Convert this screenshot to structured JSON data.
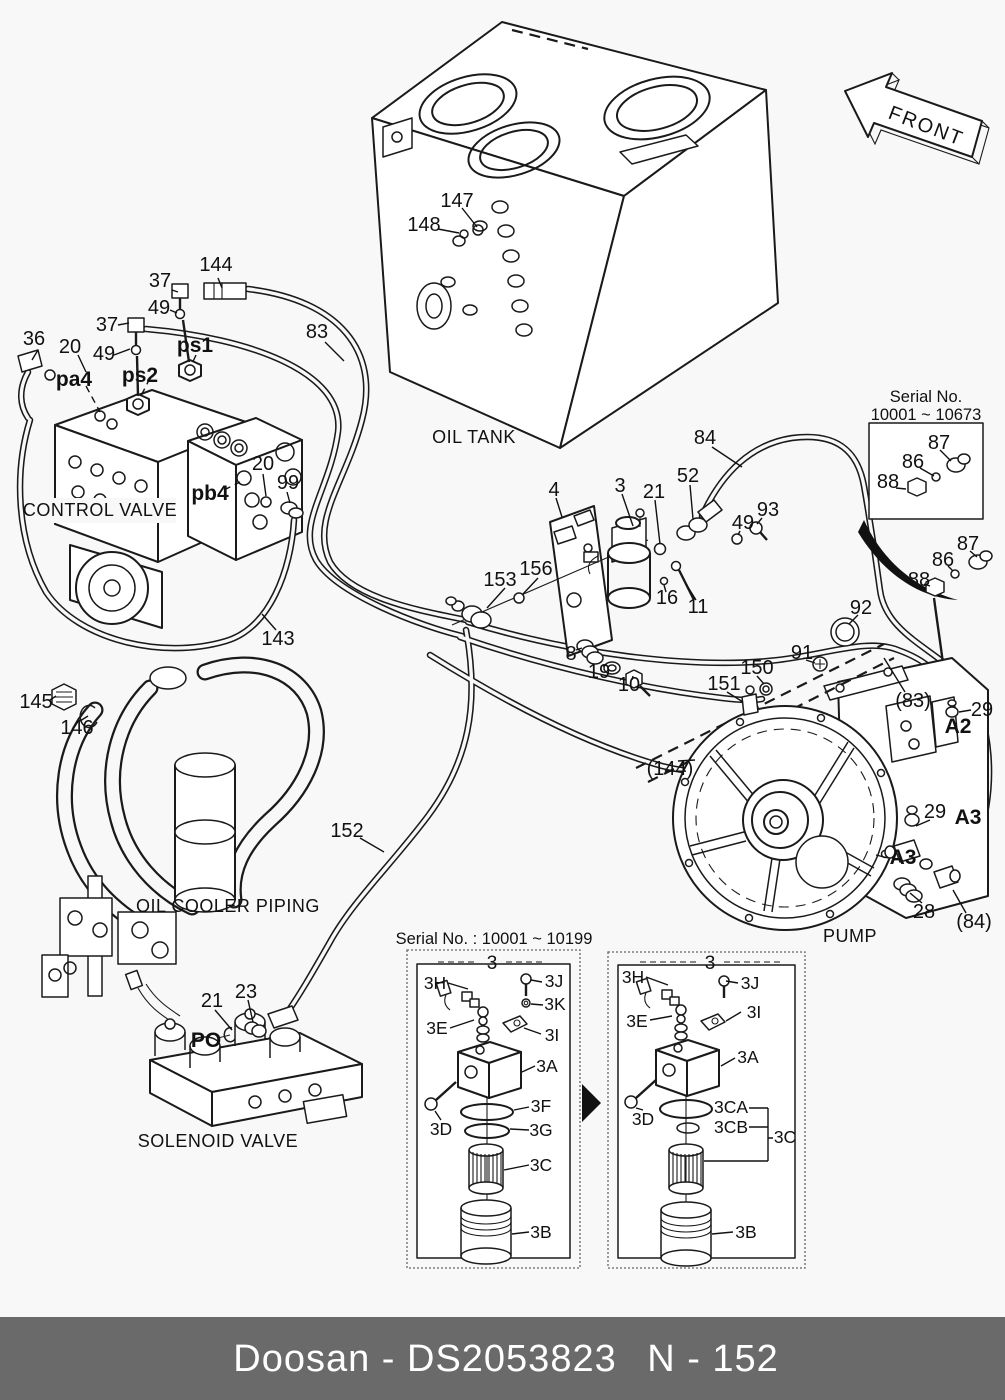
{
  "footer": {
    "brand_part": "Doosan - DS2053823",
    "page_no": "N - 152",
    "bg_color": "#6a6a6a"
  },
  "front_arrow_label": "FRONT",
  "section_labels": {
    "oil_tank": "OIL TANK",
    "control_valve": "CONTROL VALVE",
    "oil_cooler_piping": "OIL COOLER PIPING",
    "solenoid_valve": "SOLENOID VALVE",
    "pump": "PUMP"
  },
  "serial_note_top": {
    "line1": "Serial No.",
    "line2": "10001 ~ 10673"
  },
  "inset_left": {
    "title": "Serial No. : 10001 ~ 10199",
    "group": "3",
    "p3h": "3H",
    "p3j": "3J",
    "p3k": "3K",
    "p3e": "3E",
    "p3i": "3I",
    "p3a": "3A",
    "p3d": "3D",
    "p3f": "3F",
    "p3g": "3G",
    "p3c": "3C",
    "p3b": "3B"
  },
  "inset_right": {
    "group": "3",
    "p3h": "3H",
    "p3j": "3J",
    "p3e": "3E",
    "p3i": "3I",
    "p3a": "3A",
    "p3d": "3D",
    "p3ca": "3CA",
    "p3cb": "3CB",
    "p3c": "3C",
    "p3b": "3B"
  },
  "callouts": {
    "c144": "144",
    "c37a": "37",
    "c49a": "49",
    "c37b": "37",
    "c36": "36",
    "c20a": "20",
    "c49b": "49",
    "ps1": "ps1",
    "ps2": "ps2",
    "pa4": "pa4",
    "c83": "83",
    "c147": "147",
    "c148": "148",
    "pb4": "pb4",
    "c20b": "20",
    "c99": "99",
    "c143": "143",
    "c4": "4",
    "c3": "3",
    "c21a": "21",
    "c52": "52",
    "c84": "84",
    "c49c": "49",
    "c93": "93",
    "c153": "153",
    "c156": "156",
    "c16": "16",
    "c11": "11",
    "c8": "8",
    "c19": "19",
    "c10": "10",
    "c87a": "87",
    "c86a": "86",
    "c88a": "88",
    "c87b": "87",
    "c86b": "86",
    "c88b": "88",
    "c92": "92",
    "c91": "91",
    "c83p": "(83)",
    "c29a": "29",
    "a2": "A2",
    "c150": "150",
    "c151": "151",
    "c144p": "(144)",
    "c29b": "29",
    "a3a": "A3",
    "a3b": "A3",
    "c28": "28",
    "c84p": "(84)",
    "c145": "145",
    "c146": "146",
    "c152": "152",
    "c21b": "21",
    "c23": "23",
    "po": "PO"
  }
}
